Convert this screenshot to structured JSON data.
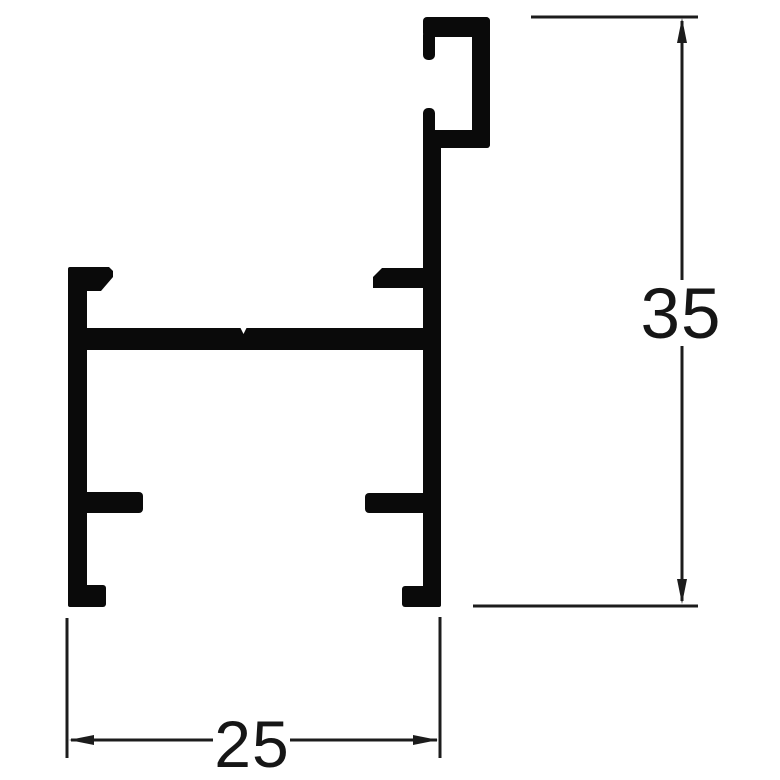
{
  "drawing": {
    "kind": "extrusion-profile-cross-section",
    "dimensions": {
      "vertical": {
        "label": "35"
      },
      "horizontal": {
        "label": "25"
      }
    },
    "colors": {
      "profile_fill": "#0a0a0a",
      "dimension_line": "#1c1c1c",
      "text": "#161616",
      "background": "#ffffff"
    }
  }
}
